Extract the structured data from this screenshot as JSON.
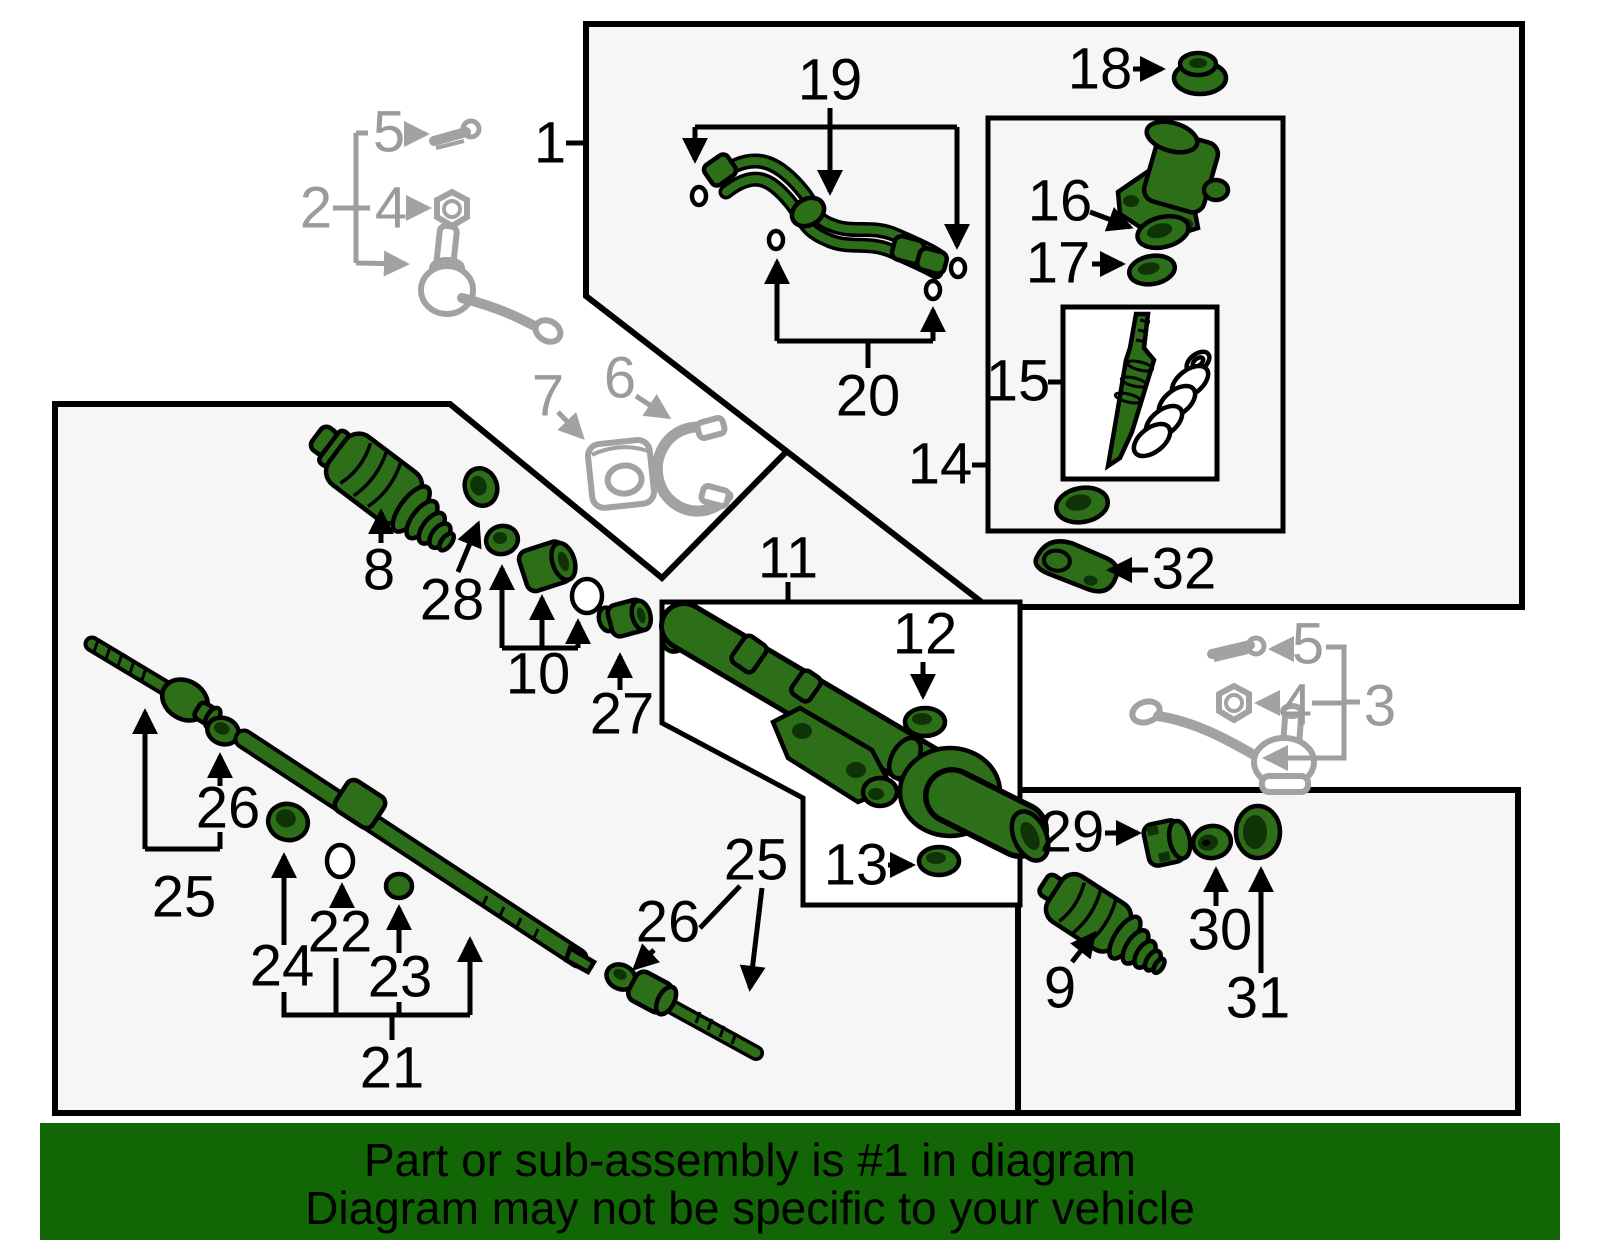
{
  "diagram_title": "Steering gear exploded parts diagram",
  "colors": {
    "part_green": "#2d6e19",
    "part_green_dark": "#0f3307",
    "gray_part": "#a2a2a2",
    "gray_label": "#9b9b9b",
    "box_fill": "#f6f6f6",
    "white_box_fill": "#ffffff",
    "banner_green": "#136606",
    "label_black": "#000000"
  },
  "labels": {
    "n1": "1",
    "n2": "2",
    "n3": "3",
    "n4": "4",
    "n5": "5",
    "n6": "6",
    "n7": "7",
    "n8": "8",
    "n9": "9",
    "n10": "10",
    "n11": "11",
    "n12": "12",
    "n13": "13",
    "n14": "14",
    "n15": "15",
    "n16": "16",
    "n17": "17",
    "n18": "18",
    "n19": "19",
    "n20": "20",
    "n21": "21",
    "n22": "22",
    "n23": "23",
    "n24": "24",
    "n25": "25",
    "n26": "26",
    "n27": "27",
    "n28": "28",
    "n29": "29",
    "n30": "30",
    "n31": "31",
    "n32": "32"
  },
  "banner": {
    "line1": "Part or sub-assembly is #1 in diagram",
    "line2": "Diagram may not be specific to your vehicle"
  }
}
